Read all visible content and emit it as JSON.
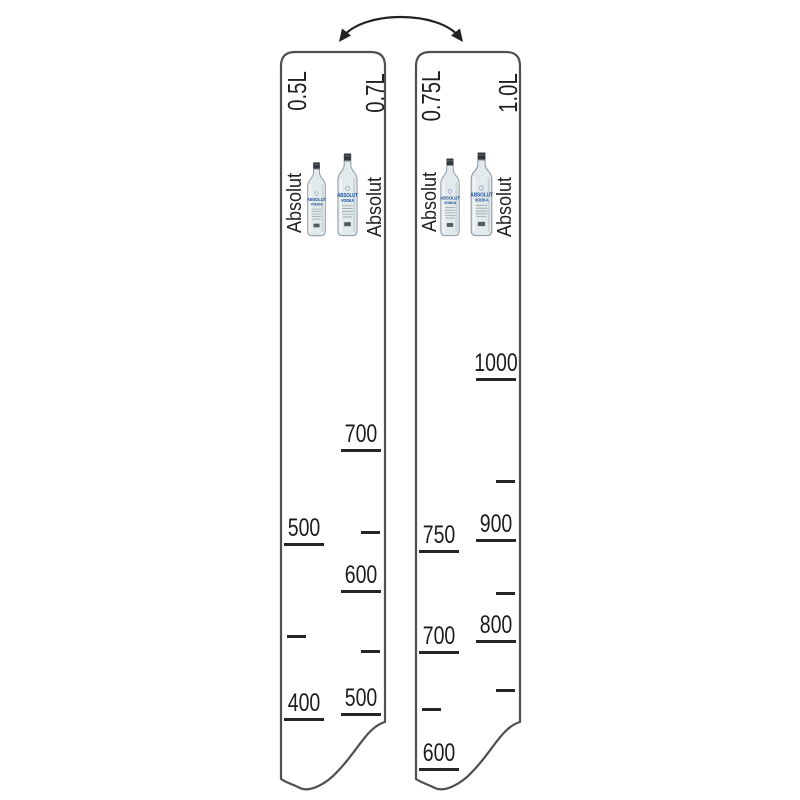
{
  "page": {
    "background": "#ffffff",
    "outline_color": "#4f4f4f",
    "tick_color": "#262626",
    "text_color": "#1b1b1b",
    "bottle_text_color": "#1d4f9e"
  },
  "icons": {
    "flip_arrow": "curved-double-headed-arrow",
    "bottle": "absolut-vodka-bottle"
  },
  "bottle_label": {
    "line1": "ABSOLUT",
    "line2": "VODKA"
  },
  "strips": [
    {
      "name": "bar-ruler-strip-0.5L-0.7L",
      "columns": [
        {
          "side": "left",
          "volume_label": "0.5L",
          "brand_label": "Absolut",
          "ticks": [
            {
              "label": "500",
              "y": 491
            },
            {
              "label": "",
              "y": 583
            },
            {
              "label": "400",
              "y": 666
            }
          ]
        },
        {
          "side": "right",
          "volume_label": "0.7L",
          "brand_label": "Absolut",
          "ticks": [
            {
              "label": "700",
              "y": 397
            },
            {
              "label": "",
              "y": 479
            },
            {
              "label": "600",
              "y": 538
            },
            {
              "label": "",
              "y": 598
            },
            {
              "label": "500",
              "y": 661
            }
          ]
        }
      ]
    },
    {
      "name": "bar-ruler-strip-0.75L-1.0L",
      "columns": [
        {
          "side": "left",
          "volume_label": "0.75L",
          "brand_label": "Absolut",
          "ticks": [
            {
              "label": "750",
              "y": 498
            },
            {
              "label": "700",
              "y": 599
            },
            {
              "label": "",
              "y": 656
            },
            {
              "label": "600",
              "y": 716
            }
          ]
        },
        {
          "side": "right",
          "volume_label": "1.0L",
          "brand_label": "Absolut",
          "ticks": [
            {
              "label": "1000",
              "y": 326
            },
            {
              "label": "",
              "y": 428
            },
            {
              "label": "900",
              "y": 487
            },
            {
              "label": "",
              "y": 540
            },
            {
              "label": "800",
              "y": 588
            },
            {
              "label": "",
              "y": 637
            }
          ]
        }
      ]
    }
  ]
}
